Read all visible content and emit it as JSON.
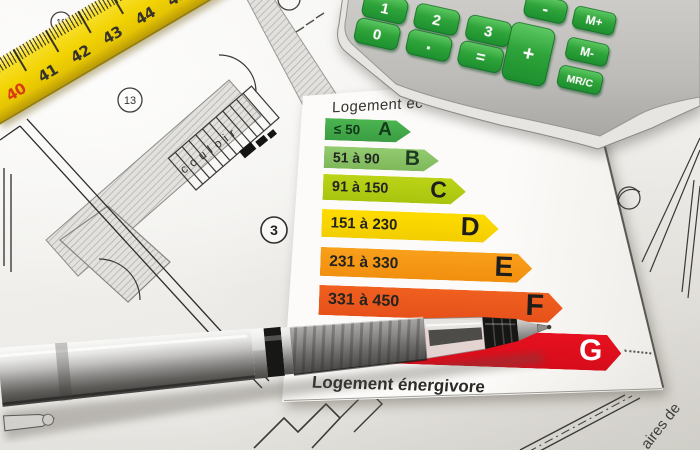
{
  "energy_label": {
    "title_top": "Logement éc",
    "title_bottom": "Logement énergivore",
    "bars": [
      {
        "letter": "A",
        "range": "≤ 50",
        "color": "#41a647"
      },
      {
        "letter": "B",
        "range": "51 à 90",
        "color": "#8ec76b"
      },
      {
        "letter": "C",
        "range": "91 à 150",
        "color": "#b7d214"
      },
      {
        "letter": "D",
        "range": "151 à 230",
        "color": "#fed900"
      },
      {
        "letter": "E",
        "range": "231 à 330",
        "color": "#f79a16"
      },
      {
        "letter": "F",
        "range": "331 à 450",
        "color": "#ee5b20"
      },
      {
        "letter": "G",
        "range": "",
        "color": "#e30e19"
      }
    ]
  },
  "calculator": {
    "keys": {
      "k1": "1",
      "k2": "2",
      "k3": "3",
      "k0": "0",
      "dot": ".",
      "eq": "=",
      "minus": "-",
      "plus": "+",
      "mplus": "M+",
      "mminus": "M-",
      "mrc": "MR/C"
    },
    "key_color": "#2fa43a",
    "body_color": "#c6c5c2"
  },
  "ruler": {
    "numbers": [
      "40",
      "41",
      "42",
      "43",
      "44",
      "45",
      "46"
    ],
    "color": "#f2d303",
    "first_number_color": "#d93a10"
  },
  "blueprint": {
    "corridor_label": "couloir",
    "margin_label": "aires de",
    "room_numbers": [
      "11",
      "13",
      "3"
    ]
  },
  "chart_data": {
    "type": "bar",
    "categories": [
      "A",
      "B",
      "C",
      "D",
      "E",
      "F",
      "G"
    ],
    "ranges": [
      "≤ 50",
      "51 à 90",
      "91 à 150",
      "151 à 230",
      "231 à 330",
      "331 à 450",
      null
    ],
    "values": [
      50,
      90,
      150,
      230,
      330,
      450,
      null
    ],
    "colors": [
      "#41a647",
      "#8ec76b",
      "#b7d214",
      "#fed900",
      "#f79a16",
      "#ee5b20",
      "#e30e19"
    ],
    "title": "Logement éc",
    "xlabel": "",
    "ylabel": "",
    "annotations": [
      "Logement énergivore"
    ],
    "legend_position": "none",
    "grid": false
  }
}
